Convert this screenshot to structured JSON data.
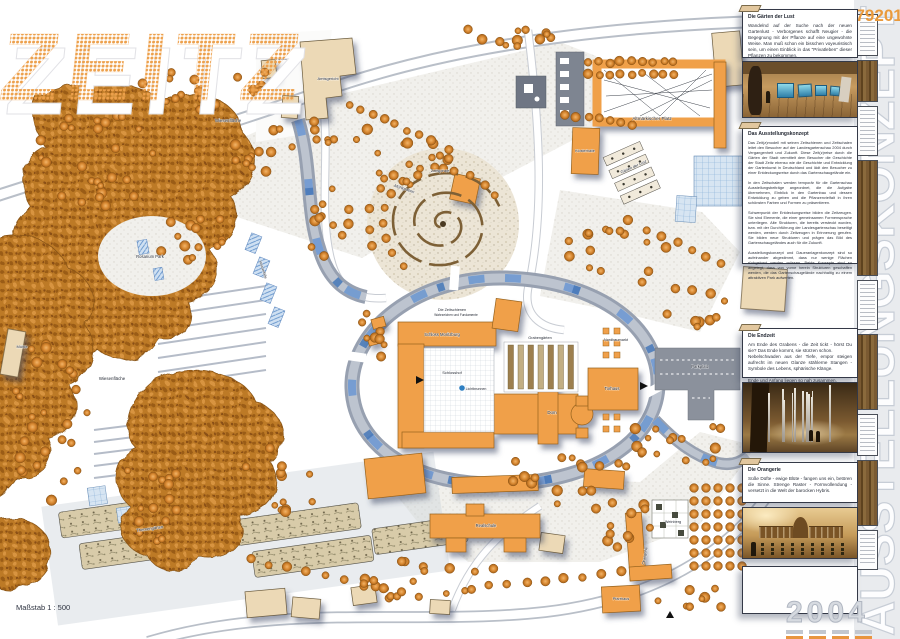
{
  "meta": {
    "logo": "ZEITZ",
    "sheet_number": "579201",
    "scale_label": "Maßstab 1 : 500"
  },
  "watermarks": {
    "vertical_title": "AUSSTELLUNGSKONZEPT",
    "year": "2004"
  },
  "colors": {
    "accent_orange": "#f0a04a",
    "tree_orange": "#d98a33",
    "tan_building": "#ecd9b6",
    "water_blue": "#4678b8",
    "road_gray": "#b9bfc8",
    "watermark_gray": "#c7cdd6"
  },
  "sidebar": {
    "panels": [
      {
        "title": "Die Gärten der Lust",
        "body": "Wandelnd auf der Suche nach der neuen Gartenlust - Verborgenes schafft Neugier - die Begegnung mit der Pflanze auf eine ungewohnte Weise. Man muß schon ein bisschen voyeuristisch sein, um einen Einblick in das \"Privatleben\" dieser Pflanzen zu bekommen."
      },
      {
        "title": "Das Ausstellungskonzept",
        "body": "Das Zeit(z)modell mit seinen Zeitschienen und Zeitschalen leitet den Besucher auf der Landesgartenschau 2004 durch Vergangenheit und Zukunft. Diese Zeit(z)reise durch die Gärten der Stadt vermittelt dem Besucher die Geschichte der Stadt Zeitz ebenso wie die Geschichte und Entwicklung der Gartenkunst in Deutschland und lädt den Besucher zu einer Entdeckungsreise durch das Gartenschaugelände ein.\n\nIn den Zeitschalen werden temporär für die Gartenschau Ausstellungsbeiträge angeordnet, die die Aufgabe übernehmen, Einblick in den Gartenbau und dessen Entwicklung zu geben und die Pflanzenvielfalt in ihren schönsten Farben und Formen zu präsentieren.\n\nSchwerpunkt der Entdeckungsreise bilden die Zeitzeugen. Sie sind Elemente, die einer gemeinsamen Formensprache unterliegen. Alte Strukturen, die bereits versteckt wurden, bzw. mit der Durchführung der Landesgartenschau beseitigt werden, werden durch Zeitzeugen in Erinnerung gerufen. Sie bilden neue Strukturen und prägen das Bild des Gartenschaugeländes auch für die Zukunft.\n\nAusstellungskonzept und Daueranlagenkonzept sind so aufeinander abgestimmt, dass nur wenige Flächen rückgebaut werden müssen. Beide Konzepte sind so angelegt, dass von vorne herein Strukturen geschaffen werden, die das Gartenschaugelände nachhaltig zu einem attraktiven Park aufwerten."
      },
      {
        "title": "Die Endzeit",
        "body": "Am Ende des Grabens - die Zeit tickt - hörst Du sie? Das Ende kommt, sie stürzen schon.\nNebelschwaden aus der Tiefe, empor steigen aufrecht im neuen Glanze stählerne Stangen - Symbole des Lebens, sphärische Klänge.\n\nEnde und Anfang liegen so nah zusammen."
      },
      {
        "title": "Die Orangerie",
        "body": "Süße Düfte - ewige Blüte - fangen uns ein, betören die Sinne. Strenge Raster - Formvollendung - versetzt in die Welt der barocken Hybris."
      }
    ],
    "photos": [
      {
        "name": "exhibition-cubes"
      },
      {
        "name": "endzeit-forest"
      },
      {
        "name": "orangerie-view"
      }
    ],
    "strip_items": [
      {
        "type": "box",
        "y": 14,
        "h": 42
      },
      {
        "type": "photo",
        "y": 60,
        "h": 42
      },
      {
        "type": "box",
        "y": 106,
        "h": 50
      },
      {
        "type": "photo",
        "y": 160,
        "h": 116
      },
      {
        "type": "box",
        "y": 280,
        "h": 50
      },
      {
        "type": "photo",
        "y": 334,
        "h": 76
      },
      {
        "type": "box",
        "y": 414,
        "h": 42
      },
      {
        "type": "photo",
        "y": 460,
        "h": 66
      },
      {
        "type": "box",
        "y": 530,
        "h": 40
      }
    ]
  },
  "map": {
    "labels": [
      {
        "t": "Herzog-Moritz-",
        "x": 289,
        "y": 60,
        "s": 4
      },
      {
        "t": "Platz",
        "x": 289,
        "y": 65,
        "s": 4
      },
      {
        "t": "Amtsgericht",
        "x": 328,
        "y": 80,
        "s": 4
      },
      {
        "t": "Wiesenfläche",
        "x": 228,
        "y": 122,
        "s": 4.4
      },
      {
        "t": "Altmärkischer Platz",
        "x": 652,
        "y": 120,
        "s": 4.6
      },
      {
        "t": "Klosterhalle",
        "x": 585,
        "y": 152,
        "s": 3.8
      },
      {
        "t": "Gärten der Lust",
        "x": 634,
        "y": 168,
        "s": 4,
        "r": -24
      },
      {
        "t": "Zeitspirale",
        "x": 440,
        "y": 172,
        "s": 4
      },
      {
        "t": "Mühlgraben",
        "x": 404,
        "y": 190,
        "s": 4,
        "r": 18
      },
      {
        "t": "Rosarium Park",
        "x": 150,
        "y": 258,
        "s": 4.2
      },
      {
        "t": "Wasserfälle",
        "x": 262,
        "y": 270,
        "s": 3.6,
        "r": 72
      },
      {
        "t": "Mühle",
        "x": 22,
        "y": 348,
        "s": 4
      },
      {
        "t": "Wiesenfläche",
        "x": 112,
        "y": 380,
        "s": 4.4
      },
      {
        "t": "Die Zeitschienen",
        "x": 452,
        "y": 311,
        "s": 3.8
      },
      {
        "t": "Wahrzeichen und Fundamente",
        "x": 456,
        "y": 316,
        "s": 3.2
      },
      {
        "t": "Schloss Moritzburg",
        "x": 442,
        "y": 336,
        "s": 4.2
      },
      {
        "t": "Schlosshof",
        "x": 452,
        "y": 374,
        "s": 4
      },
      {
        "t": "Lichtbrunnen",
        "x": 476,
        "y": 390,
        "s": 3.6
      },
      {
        "t": "Dom",
        "x": 552,
        "y": 414,
        "s": 4.4
      },
      {
        "t": "Grabengärten",
        "x": 540,
        "y": 339,
        "s": 3.8
      },
      {
        "t": "Nordbaumarkt",
        "x": 616,
        "y": 341,
        "s": 3.8
      },
      {
        "t": "Torhaus",
        "x": 612,
        "y": 390,
        "s": 4.2
      },
      {
        "t": "Parkplatz",
        "x": 700,
        "y": 368,
        "s": 4.2
      },
      {
        "t": "Orangerie",
        "x": 646,
        "y": 556,
        "s": 4,
        "r": -80
      },
      {
        "t": "Weinberg",
        "x": 673,
        "y": 523,
        "s": 3.8
      },
      {
        "t": "Realschule",
        "x": 486,
        "y": 527,
        "s": 4.2
      },
      {
        "t": "Pfarrhaus",
        "x": 621,
        "y": 600,
        "s": 3.8
      },
      {
        "t": "Themengärten",
        "x": 150,
        "y": 530,
        "s": 4.2,
        "r": -8
      }
    ],
    "tree_clusters": [
      [
        500,
        38,
        55,
        12,
        12
      ],
      [
        182,
        92,
        55,
        20,
        14
      ],
      [
        262,
        150,
        34,
        26,
        12
      ],
      [
        330,
        228,
        22,
        40,
        12
      ],
      [
        410,
        162,
        48,
        26,
        14
      ],
      [
        96,
        162,
        66,
        50,
        26
      ],
      [
        190,
        232,
        38,
        30,
        14
      ],
      [
        58,
        420,
        50,
        84,
        26
      ],
      [
        148,
        500,
        40,
        44,
        16
      ],
      [
        372,
        332,
        14,
        36,
        8
      ],
      [
        620,
        252,
        55,
        36,
        16
      ],
      [
        694,
        300,
        38,
        28,
        10
      ],
      [
        560,
        480,
        78,
        26,
        16
      ],
      [
        428,
        582,
        88,
        22,
        18
      ],
      [
        618,
        520,
        36,
        34,
        12
      ],
      [
        700,
        442,
        28,
        22,
        8
      ],
      [
        282,
        478,
        44,
        36,
        12
      ],
      [
        338,
        130,
        30,
        18,
        8
      ],
      [
        640,
        440,
        30,
        20,
        8
      ],
      [
        690,
        600,
        40,
        18,
        8
      ],
      [
        250,
        80,
        20,
        14,
        6
      ]
    ],
    "tree_rows": [
      [
        588,
        62,
        674,
        62,
        9
      ],
      [
        588,
        74,
        674,
        74,
        9
      ],
      [
        566,
        114,
        632,
        124,
        7
      ],
      [
        350,
        104,
        430,
        140,
        8
      ],
      [
        250,
        560,
        420,
        596,
        10
      ],
      [
        470,
        588,
        620,
        572,
        9
      ],
      [
        648,
        230,
        720,
        262,
        6
      ]
    ],
    "tree_arcs": [
      {
        "cx": 443,
        "cy": 224,
        "r": 60,
        "a0": 130,
        "a1": 330,
        "n": 13
      },
      {
        "cx": 443,
        "cy": 224,
        "r": 74,
        "a0": 160,
        "a1": 260,
        "n": 7
      }
    ],
    "tree_grids": [
      {
        "x": 694,
        "y": 488,
        "cols": 5,
        "rows": 7,
        "dx": 12,
        "dy": 13,
        "r": 4.4,
        "shape": "circle"
      },
      {
        "x": 603,
        "y": 328,
        "cols": 2,
        "rows": 3,
        "dx": 11,
        "dy": 12,
        "s": 6,
        "shape": "square"
      },
      {
        "x": 603,
        "y": 414,
        "cols": 2,
        "rows": 2,
        "dx": 11,
        "dy": 12,
        "s": 6,
        "shape": "square"
      }
    ],
    "terraces": [
      {
        "x1": 158,
        "y1": 302,
        "x2": 266,
        "y2": 286,
        "n": 7,
        "dy": 14
      },
      {
        "x1": 6,
        "y1": 296,
        "x2": 76,
        "y2": 288,
        "n": 6,
        "dy": 13
      },
      {
        "x1": 94,
        "y1": 430,
        "x2": 158,
        "y2": 422,
        "n": 5,
        "dy": 12
      },
      {
        "x1": 180,
        "y1": 440,
        "x2": 236,
        "y2": 432,
        "n": 4,
        "dy": 12
      }
    ]
  }
}
